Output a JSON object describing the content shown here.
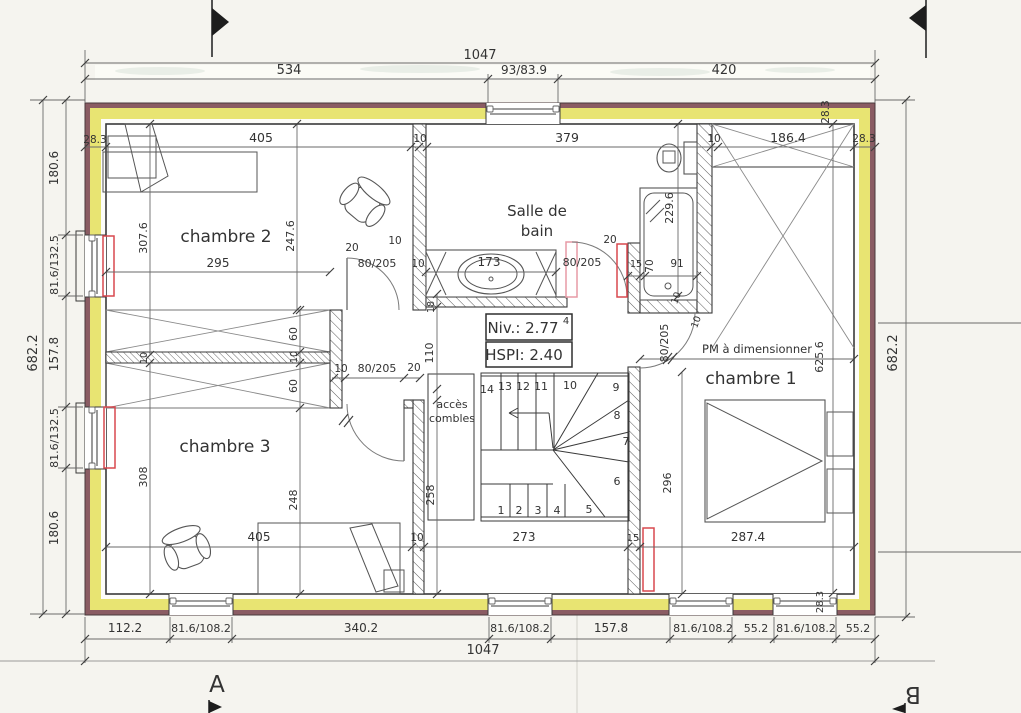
{
  "colors": {
    "paper": "#f5f4ef",
    "wall_masonry": "#8a5c63",
    "wall_insulation": "#e8e472",
    "line_dark": "#3a3a3a",
    "line_dim": "#6a6a6a",
    "text": "#333333",
    "radiator_red": "#d9484f",
    "door_pink": "#e79aa5",
    "window_gray": "#909090"
  },
  "drawing": {
    "rooms": [
      "chambre 1",
      "chambre 2",
      "chambre 3",
      "Salle de bain"
    ],
    "level_note": "Niv.: 2.77",
    "level_exponent": "4",
    "ceiling_note": "HSPI: 2.40",
    "attic_access": "accès combles",
    "door_note": "PM à dimensionner",
    "section_letters": [
      "A",
      "B"
    ],
    "overall_width": "1047",
    "overall_height": "682.2"
  },
  "labels": [
    {
      "name": "dim-top-total",
      "t": "1047",
      "x": 480,
      "y": 59,
      "s": 13
    },
    {
      "name": "dim-top-534",
      "t": "534",
      "x": 289,
      "y": 74,
      "s": 13
    },
    {
      "name": "dim-top-window",
      "t": "93/83.9",
      "x": 524,
      "y": 74,
      "s": 12
    },
    {
      "name": "dim-top-420",
      "t": "420",
      "x": 724,
      "y": 74,
      "s": 13
    },
    {
      "name": "dim-label",
      "t": "28.3",
      "x": 95,
      "y": 143,
      "s": 10.5
    },
    {
      "name": "dim-label",
      "t": "405",
      "x": 261,
      "y": 142,
      "s": 12.5
    },
    {
      "name": "dim-label",
      "t": "10",
      "x": 420,
      "y": 142,
      "s": 10.5
    },
    {
      "name": "dim-label",
      "t": "379",
      "x": 567,
      "y": 142,
      "s": 12.5
    },
    {
      "name": "dim-label",
      "t": "10",
      "x": 714,
      "y": 142,
      "s": 10.5
    },
    {
      "name": "dim-label",
      "t": "186.4",
      "x": 788,
      "y": 142,
      "s": 12.5
    },
    {
      "name": "dim-label",
      "t": "28.3",
      "x": 864,
      "y": 142,
      "s": 10.5
    },
    {
      "name": "dim-label",
      "t": "28.3",
      "x": 829,
      "y": 112,
      "r": -90,
      "s": 10.5
    },
    {
      "name": "dim-left-total",
      "t": "682.2",
      "x": 37,
      "y": 353,
      "r": -90,
      "s": 13
    },
    {
      "name": "dim-label",
      "t": "180.6",
      "x": 58,
      "y": 168,
      "r": -90,
      "s": 12
    },
    {
      "name": "dim-label",
      "t": "81.6/132.5",
      "x": 58,
      "y": 265,
      "r": -90,
      "s": 11
    },
    {
      "name": "dim-label",
      "t": "157.8",
      "x": 58,
      "y": 354,
      "r": -90,
      "s": 12
    },
    {
      "name": "dim-label",
      "t": "81.6/132.5",
      "x": 58,
      "y": 438,
      "r": -90,
      "s": 11
    },
    {
      "name": "dim-label",
      "t": "180.6",
      "x": 58,
      "y": 528,
      "r": -90,
      "s": 12
    },
    {
      "name": "dim-right-total",
      "t": "682.2",
      "x": 897,
      "y": 353,
      "r": -90,
      "s": 13
    },
    {
      "name": "dim-label",
      "t": "112.2",
      "x": 125,
      "y": 632,
      "s": 12
    },
    {
      "name": "dim-label",
      "t": "81.6/108.2",
      "x": 201,
      "y": 632,
      "s": 11
    },
    {
      "name": "dim-label",
      "t": "340.2",
      "x": 361,
      "y": 632,
      "s": 12
    },
    {
      "name": "dim-label",
      "t": "81.6/108.2",
      "x": 520,
      "y": 632,
      "s": 11
    },
    {
      "name": "dim-label",
      "t": "157.8",
      "x": 611,
      "y": 632,
      "s": 12
    },
    {
      "name": "dim-label",
      "t": "81.6/108.2",
      "x": 703,
      "y": 632,
      "s": 11
    },
    {
      "name": "dim-label",
      "t": "55.2",
      "x": 756,
      "y": 632,
      "s": 11
    },
    {
      "name": "dim-label",
      "t": "81.6/108.2",
      "x": 806,
      "y": 632,
      "s": 11
    },
    {
      "name": "dim-label",
      "t": "55.2",
      "x": 858,
      "y": 632,
      "s": 11
    },
    {
      "name": "dim-bottom-total",
      "t": "1047",
      "x": 483,
      "y": 654,
      "s": 13
    },
    {
      "name": "dim-label",
      "t": "28.3",
      "x": 823,
      "y": 602,
      "r": -90,
      "s": 10
    },
    {
      "name": "room-label-chambre2",
      "t": "chambre 2",
      "x": 226,
      "y": 242,
      "s": 17
    },
    {
      "name": "room-label-salle-de-bain-1",
      "t": "Salle de",
      "x": 537,
      "y": 216,
      "s": 15
    },
    {
      "name": "room-label-salle-de-bain-2",
      "t": "bain",
      "x": 537,
      "y": 236,
      "s": 15
    },
    {
      "name": "room-label-chambre1",
      "t": "chambre 1",
      "x": 751,
      "y": 384,
      "s": 17
    },
    {
      "name": "room-label-chambre3",
      "t": "chambre 3",
      "x": 225,
      "y": 452,
      "s": 17
    },
    {
      "name": "label-acces-combles-1",
      "t": "accès",
      "x": 452,
      "y": 408,
      "s": 11
    },
    {
      "name": "label-acces-combles-2",
      "t": "combles",
      "x": 452,
      "y": 422,
      "s": 11
    },
    {
      "name": "label-pm-a-dimensionner",
      "t": "PM à dimensionner",
      "x": 757,
      "y": 353,
      "s": 11.5
    },
    {
      "name": "niv-value",
      "t": "Niv.: 2.77",
      "x": 523,
      "y": 333,
      "s": 15
    },
    {
      "name": "niv-exponent",
      "t": "4",
      "x": 566,
      "y": 324,
      "s": 10
    },
    {
      "name": "hspi-value",
      "t": "HSPI: 2.40",
      "x": 524,
      "y": 360,
      "s": 15
    },
    {
      "name": "dim-label",
      "t": "307.6",
      "x": 147,
      "y": 238,
      "r": -90,
      "s": 11
    },
    {
      "name": "dim-label",
      "t": "295",
      "x": 218,
      "y": 267,
      "s": 12
    },
    {
      "name": "dim-label",
      "t": "247.6",
      "x": 294,
      "y": 236,
      "r": -90,
      "s": 11
    },
    {
      "name": "dim-label",
      "t": "20",
      "x": 352,
      "y": 251,
      "s": 10.5
    },
    {
      "name": "dim-label",
      "t": "10",
      "x": 395,
      "y": 244,
      "s": 10.5
    },
    {
      "name": "dim-label",
      "t": "80/205",
      "x": 377,
      "y": 267,
      "s": 11
    },
    {
      "name": "dim-label",
      "t": "10",
      "x": 418,
      "y": 267,
      "s": 10.5
    },
    {
      "name": "dim-label",
      "t": "60",
      "x": 297,
      "y": 334,
      "r": -90,
      "s": 11
    },
    {
      "name": "dim-label",
      "t": "10",
      "x": 297,
      "y": 357,
      "r": -90,
      "s": 9.5
    },
    {
      "name": "dim-label",
      "t": "60",
      "x": 297,
      "y": 386,
      "r": -90,
      "s": 11
    },
    {
      "name": "dim-label",
      "t": "10",
      "x": 147,
      "y": 358,
      "r": -90,
      "s": 9.5
    },
    {
      "name": "dim-label",
      "t": "10",
      "x": 341,
      "y": 372,
      "s": 10.5
    },
    {
      "name": "dim-label",
      "t": "80/205",
      "x": 377,
      "y": 372,
      "s": 11
    },
    {
      "name": "dim-label",
      "t": "20",
      "x": 414,
      "y": 371,
      "s": 10.5
    },
    {
      "name": "dim-label",
      "t": "308",
      "x": 147,
      "y": 477,
      "r": -90,
      "s": 11
    },
    {
      "name": "dim-label",
      "t": "248",
      "x": 297,
      "y": 500,
      "r": -90,
      "s": 11
    },
    {
      "name": "dim-label",
      "t": "405",
      "x": 259,
      "y": 541,
      "s": 12
    },
    {
      "name": "dim-label",
      "t": "10",
      "x": 417,
      "y": 541,
      "s": 10.5
    },
    {
      "name": "dim-label",
      "t": "18",
      "x": 434,
      "y": 307,
      "r": -90,
      "s": 9.5
    },
    {
      "name": "dim-label",
      "t": "110",
      "x": 433,
      "y": 353,
      "r": -90,
      "s": 11
    },
    {
      "name": "dim-label",
      "t": "258",
      "x": 434,
      "y": 495,
      "r": -90,
      "s": 11
    },
    {
      "name": "dim-label",
      "t": "273",
      "x": 524,
      "y": 541,
      "s": 12
    },
    {
      "name": "dim-label",
      "t": "15",
      "x": 633,
      "y": 541,
      "s": 10
    },
    {
      "name": "stair-step-number",
      "t": "1",
      "x": 501,
      "y": 514,
      "s": 11
    },
    {
      "name": "stair-step-number",
      "t": "2",
      "x": 519,
      "y": 514,
      "s": 11
    },
    {
      "name": "stair-step-number",
      "t": "3",
      "x": 538,
      "y": 514,
      "s": 11
    },
    {
      "name": "stair-step-number",
      "t": "4",
      "x": 557,
      "y": 514,
      "s": 11
    },
    {
      "name": "stair-step-number",
      "t": "5",
      "x": 589,
      "y": 513,
      "s": 11
    },
    {
      "name": "stair-step-number",
      "t": "6",
      "x": 617,
      "y": 485,
      "s": 11
    },
    {
      "name": "stair-step-number",
      "t": "7",
      "x": 626,
      "y": 445,
      "s": 11
    },
    {
      "name": "stair-step-number",
      "t": "8",
      "x": 617,
      "y": 419,
      "s": 11
    },
    {
      "name": "stair-step-number",
      "t": "9",
      "x": 616,
      "y": 391,
      "s": 11
    },
    {
      "name": "stair-step-number",
      "t": "10",
      "x": 570,
      "y": 389,
      "s": 11
    },
    {
      "name": "stair-step-number",
      "t": "11",
      "x": 541,
      "y": 390,
      "s": 11
    },
    {
      "name": "stair-step-number",
      "t": "12",
      "x": 523,
      "y": 390,
      "s": 11
    },
    {
      "name": "stair-step-number",
      "t": "13",
      "x": 505,
      "y": 390,
      "s": 11
    },
    {
      "name": "stair-step-number",
      "t": "14",
      "x": 487,
      "y": 393,
      "s": 11
    },
    {
      "name": "dim-label",
      "t": "173",
      "x": 489,
      "y": 266,
      "s": 12
    },
    {
      "name": "dim-label",
      "t": "20",
      "x": 610,
      "y": 243,
      "s": 10.5
    },
    {
      "name": "dim-label",
      "t": "80/205",
      "x": 582,
      "y": 266,
      "s": 11
    },
    {
      "name": "dim-label",
      "t": "15",
      "x": 636,
      "y": 267,
      "s": 9.5
    },
    {
      "name": "dim-label",
      "t": "70",
      "x": 653,
      "y": 266,
      "r": -90,
      "s": 10.5
    },
    {
      "name": "dim-label",
      "t": "91",
      "x": 677,
      "y": 267,
      "s": 10.5
    },
    {
      "name": "dim-label",
      "t": "229.6",
      "x": 673,
      "y": 208,
      "r": -90,
      "s": 11
    },
    {
      "name": "dim-label",
      "t": "10",
      "x": 679,
      "y": 299,
      "r": -70,
      "s": 9.5
    },
    {
      "name": "dim-label",
      "t": "10",
      "x": 699,
      "y": 323,
      "r": -70,
      "s": 9.5
    },
    {
      "name": "dim-label",
      "t": "80/205",
      "x": 668,
      "y": 343,
      "r": -90,
      "s": 11
    },
    {
      "name": "dim-label",
      "t": "625.6",
      "x": 823,
      "y": 357,
      "r": -90,
      "s": 11
    },
    {
      "name": "dim-label",
      "t": "296",
      "x": 671,
      "y": 483,
      "r": -90,
      "s": 11
    },
    {
      "name": "dim-label",
      "t": "287.4",
      "x": 748,
      "y": 541,
      "s": 12
    },
    {
      "name": "section-letter-a",
      "t": "A",
      "x": 217,
      "y": 692,
      "s": 23
    },
    {
      "name": "section-letter-b",
      "t": "B",
      "x": 913,
      "y": 687,
      "r": 180,
      "s": 23
    }
  ]
}
